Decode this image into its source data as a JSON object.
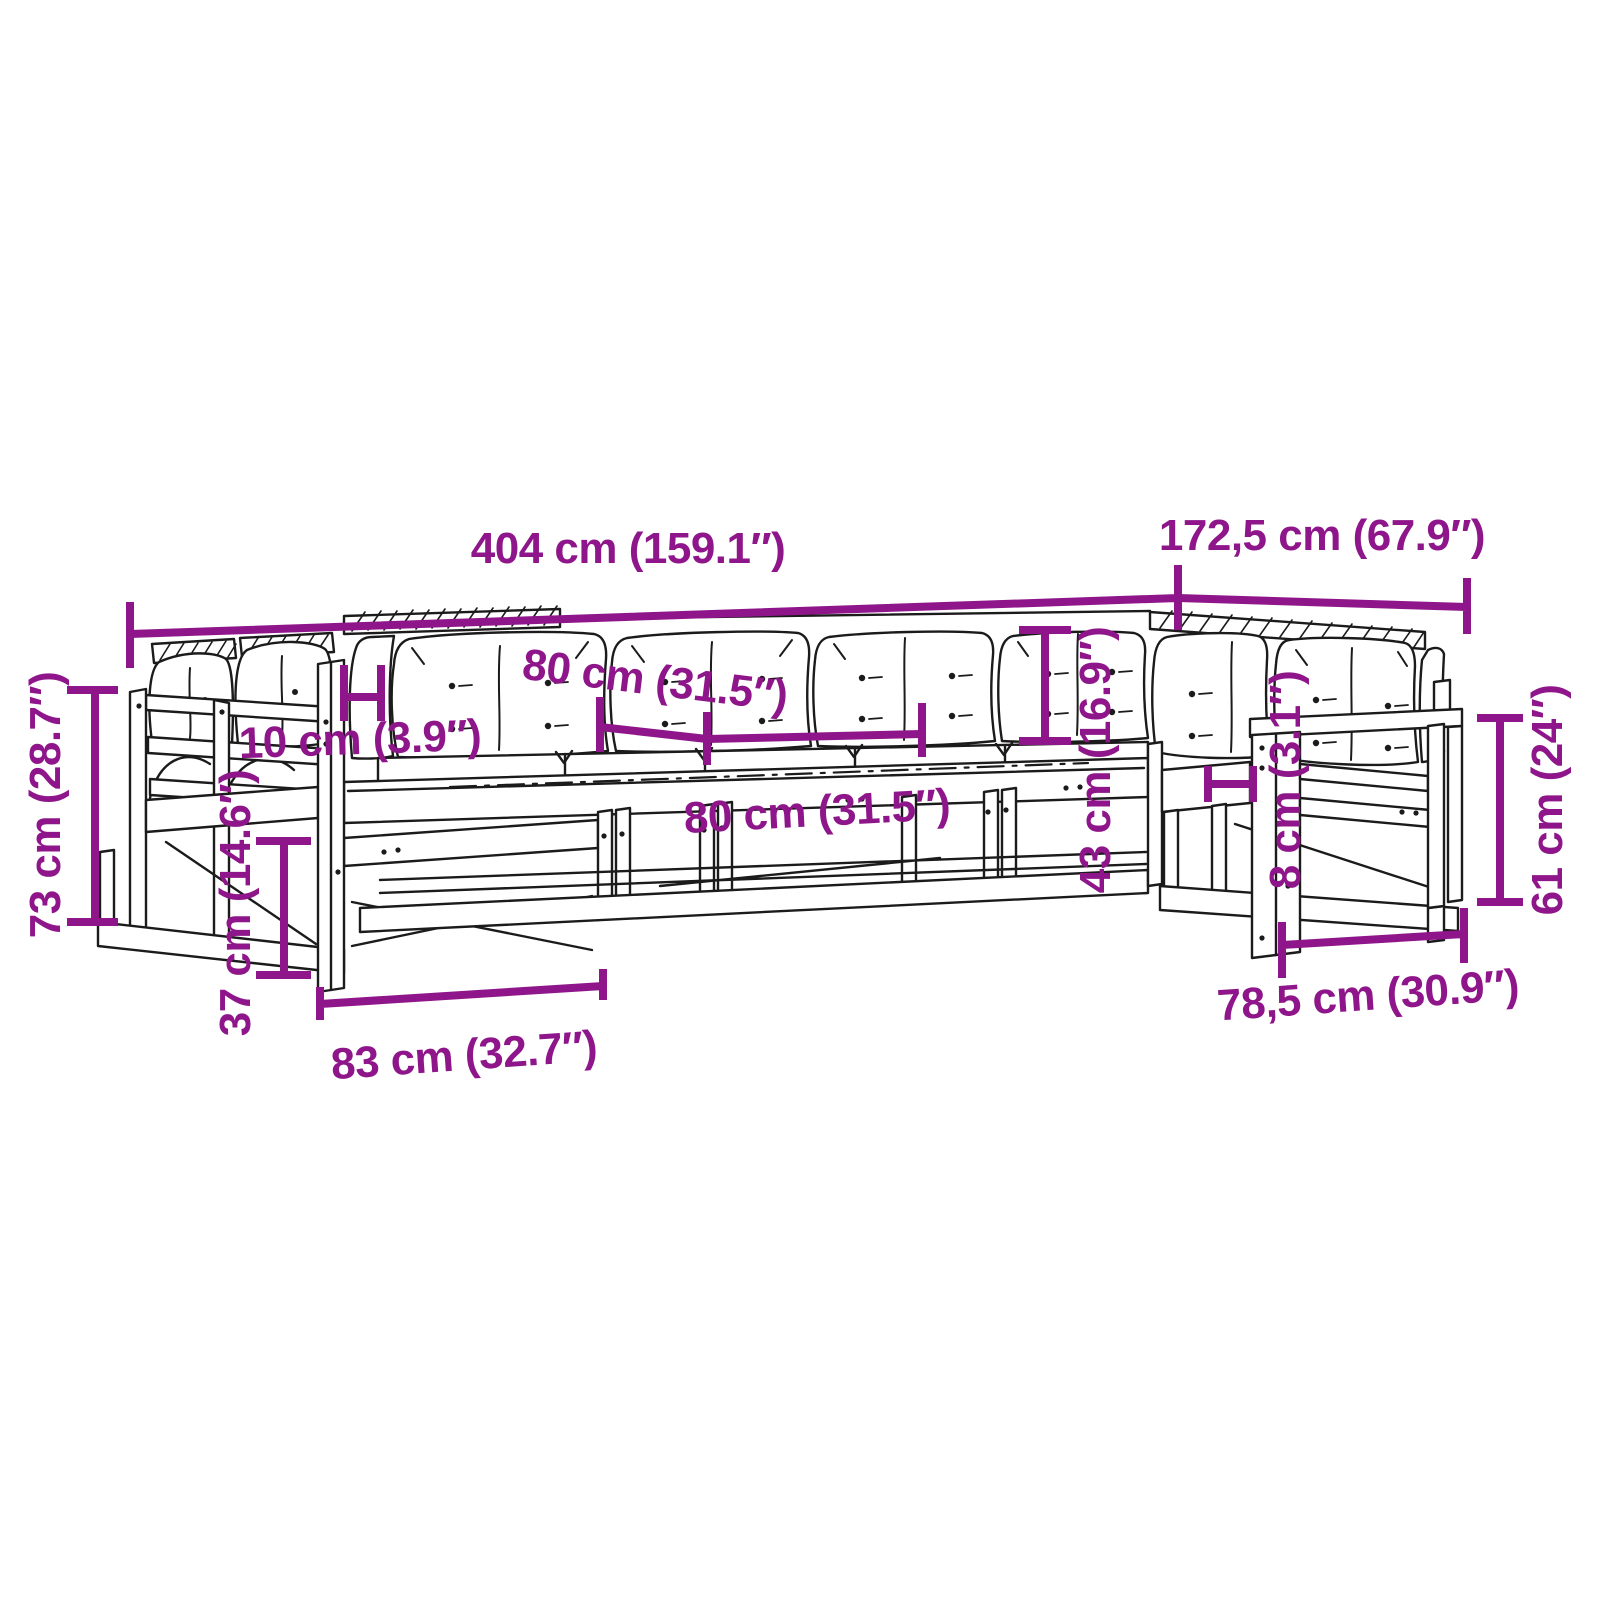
{
  "meta": {
    "type": "product-dimension-diagram",
    "subject": "wooden garden lounge sofa set with cushions, line drawing with measurements"
  },
  "colors": {
    "dimension": "#8E168A",
    "sketch": "#1b1b1b",
    "background": "#ffffff"
  },
  "dimensions": {
    "overall_width": "404 cm (159.1″)",
    "overall_depth": "172,5 cm (67.9″)",
    "overall_height": "73 cm (28.7″)",
    "armrest_width": "10 cm (3.9″)",
    "back_cushion_width": "80 cm (31.5″)",
    "seat_width": "80 cm (31.5″)",
    "backrest_height": "43 cm (16.9″)",
    "armrest_thickness": "8 cm (3.1″)",
    "armrest_height": "61 cm (24″)",
    "seat_depth": "78,5 cm (30.9″)",
    "clearance_height": "37 cm (14.6″)",
    "module_width": "83 cm (32.7″)"
  }
}
